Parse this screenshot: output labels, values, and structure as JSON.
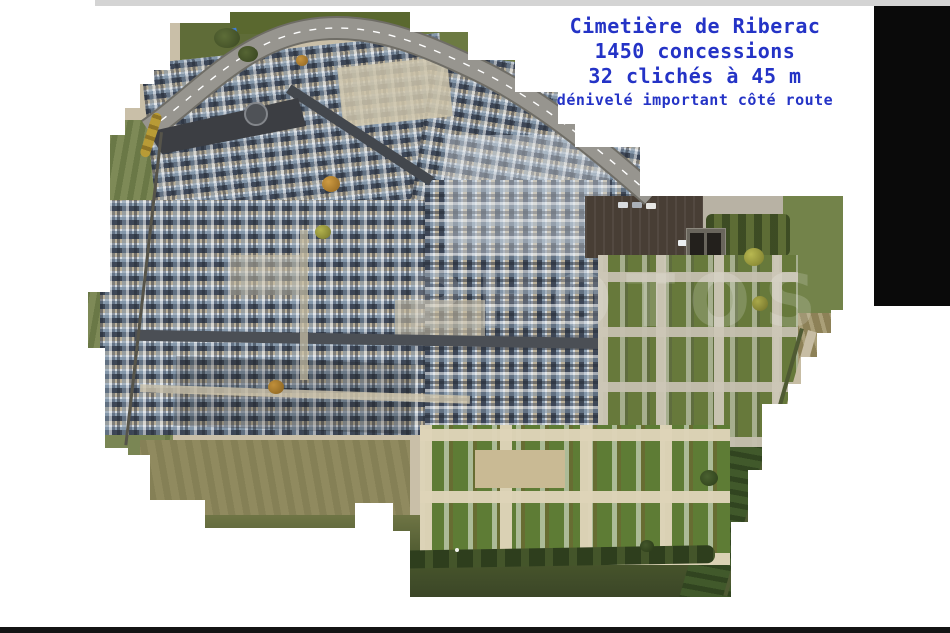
{
  "annotation": {
    "lines": [
      "Cimetière de Riberac",
      "1450 concessions",
      "32 clichés à 45 m",
      "dénivelé important côté route"
    ],
    "color": "#2433c6",
    "style": "color:#2433c6"
  },
  "watermark": {
    "text": "PHOTOS",
    "style": "color:rgba(255,255,255,0.17)"
  },
  "palette": {
    "page_background": "#ffffff",
    "letterbox_top": "#d4d4d4",
    "right_panel": "#0a0a0a",
    "letterbox_bottom": "#141414",
    "road_asphalt": "#97958f",
    "entrance_asphalt": "#3c3e43",
    "tomb_dark": "#3f4856",
    "tomb_steel_blue": "#8a9cae",
    "tomb_white": "#d3d9df",
    "path_tan": "#b9af99",
    "lawn_green": "#5e7c35",
    "section_green": "#67793b",
    "field_olive": "#8d8157",
    "hedge_dark_green": "#2e3e1d",
    "tree_orange": "#b5832f",
    "car_blue": "#3f7ed8"
  }
}
